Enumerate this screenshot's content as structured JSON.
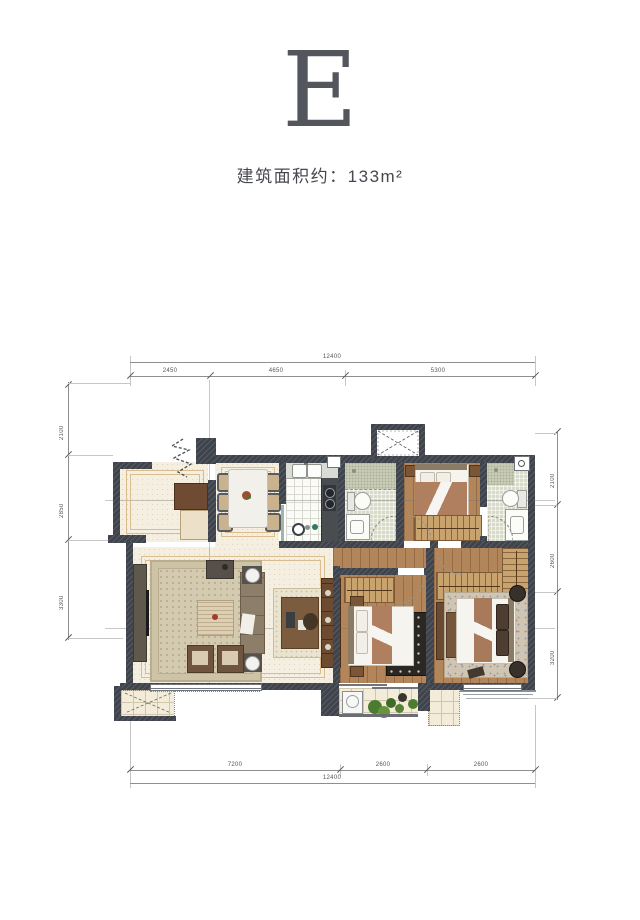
{
  "header": {
    "unit": "E",
    "area": "建筑面积约：133m²"
  },
  "dimensions": {
    "top": {
      "total": "12400",
      "segments": [
        "2450",
        "4650",
        "5300"
      ]
    },
    "bottom": {
      "total": "12400",
      "segments": [
        "7200",
        "2600",
        "2600"
      ]
    },
    "left": {
      "segments": [
        "2100",
        "2850",
        "3300"
      ]
    },
    "right": {
      "segments": [
        "2100",
        "2600",
        "3200"
      ]
    }
  },
  "palette": {
    "wall": "#3f434b",
    "wood_floor": "#b2855a",
    "cream_floor": "#f5efe1",
    "bath_tile": "#d9dbc9",
    "inlay": "#d9bd8f",
    "dark_rug": "#2b2723",
    "greenery": "#4c7c30",
    "letter": "#54565e"
  }
}
